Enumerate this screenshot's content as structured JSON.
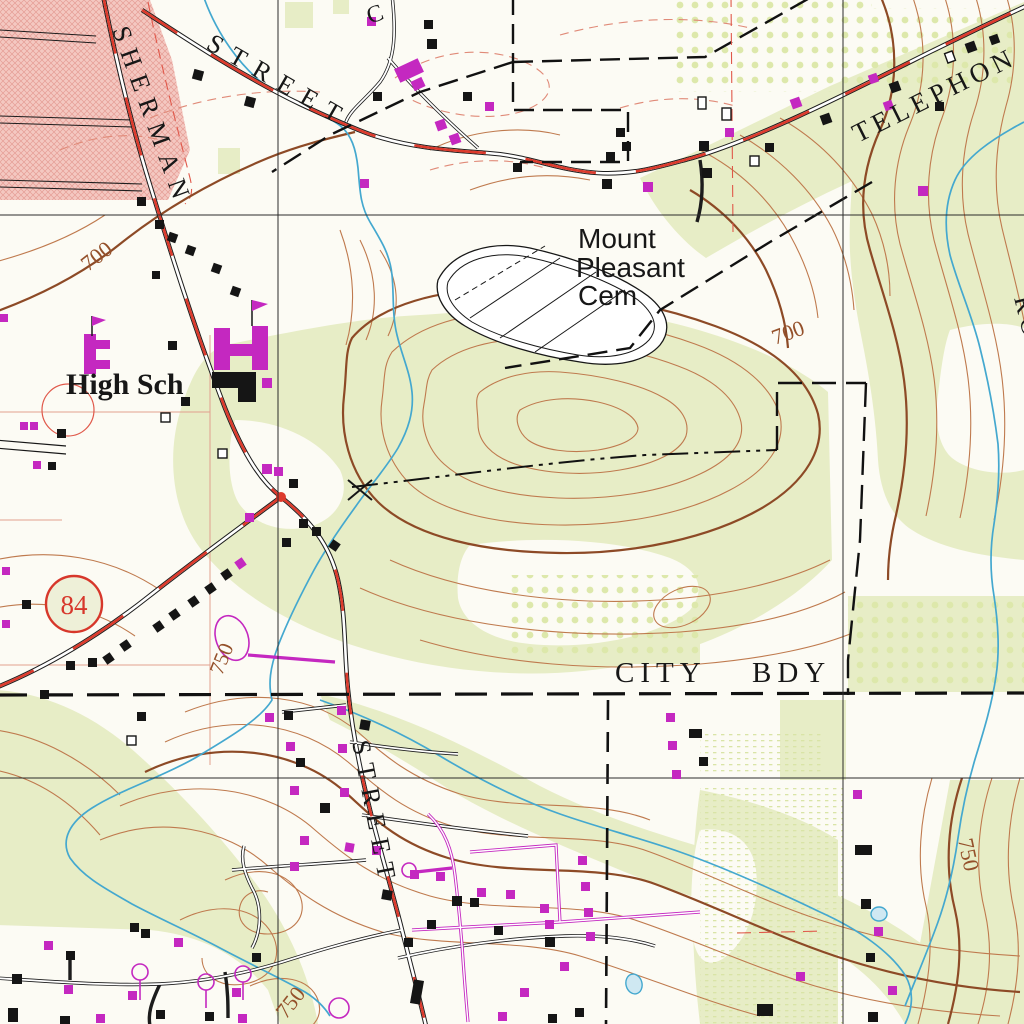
{
  "map": {
    "kind": "USGS topographic map excerpt",
    "labels": {
      "sherman": "SHERMAN",
      "street_top": "STREET",
      "street_bottom": "STREET",
      "telephone_partial": "TELEPHON",
      "c_partial": "C",
      "road_partial": "ROAD",
      "cemetery_line1": "Mount",
      "cemetery_line2": "Pleasant",
      "cemetery_line3": "Cem",
      "high_school": "High Sch",
      "city_bdy_word1": "CITY",
      "city_bdy_word2": "BDY",
      "route_number": "84"
    },
    "contour_labels": [
      {
        "text": "700"
      },
      {
        "text": "700"
      },
      {
        "text": "750"
      },
      {
        "text": "750"
      },
      {
        "text": "750"
      }
    ],
    "colors": {
      "paper": "#fcfbf4",
      "woodland_green": "#e7edc6",
      "orchard_dot": "#d5e39d",
      "urban_pink": "#f4c8c1",
      "urban_hatch": "#e59d95",
      "contour_brown": "#bf7a4e",
      "index_contour_brown": "#8d4a26",
      "road_red": "#dd3a2c",
      "photorev_magenta": "#c428c0",
      "water_blue": "#44a8cf",
      "pond_fill": "#cfe8f2",
      "ink_black": "#151515",
      "section_red": "#e0584a",
      "grid_black": "#2b2b2b"
    },
    "buildings": [
      [
        193,
        70,
        10,
        10,
        "b",
        15
      ],
      [
        245,
        97,
        10,
        10,
        "b",
        15
      ],
      [
        367,
        17,
        9,
        9,
        "m",
        0
      ],
      [
        424,
        20,
        9,
        9,
        "b",
        0
      ],
      [
        427,
        39,
        10,
        10,
        "b",
        0
      ],
      [
        137,
        197,
        9,
        9,
        "b",
        0
      ],
      [
        155,
        220,
        9,
        9,
        "b",
        0
      ],
      [
        168,
        233,
        9,
        9,
        "b",
        20
      ],
      [
        186,
        246,
        9,
        9,
        "b",
        20
      ],
      [
        152,
        271,
        8,
        8,
        "b",
        0
      ],
      [
        212,
        264,
        9,
        9,
        "b",
        20
      ],
      [
        231,
        287,
        9,
        9,
        "b",
        20
      ],
      [
        396,
        63,
        26,
        15,
        "m",
        -25
      ],
      [
        412,
        79,
        12,
        10,
        "m",
        -25
      ],
      [
        373,
        92,
        9,
        9,
        "b",
        0
      ],
      [
        463,
        92,
        9,
        9,
        "b",
        0
      ],
      [
        485,
        102,
        9,
        9,
        "m",
        0
      ],
      [
        436,
        120,
        10,
        10,
        "m",
        -20
      ],
      [
        450,
        134,
        10,
        10,
        "m",
        -20
      ],
      [
        360,
        179,
        9,
        9,
        "m",
        0
      ],
      [
        513,
        163,
        9,
        9,
        "b",
        0
      ],
      [
        602,
        179,
        10,
        10,
        "b",
        0
      ],
      [
        643,
        182,
        10,
        10,
        "m",
        0
      ],
      [
        616,
        128,
        9,
        9,
        "b",
        0
      ],
      [
        622,
        142,
        9,
        9,
        "b",
        0
      ],
      [
        606,
        152,
        9,
        9,
        "b",
        0
      ],
      [
        698,
        97,
        8,
        12,
        "h",
        0
      ],
      [
        722,
        108,
        9,
        12,
        "h",
        0
      ],
      [
        725,
        128,
        9,
        9,
        "m",
        0
      ],
      [
        699,
        141,
        10,
        10,
        "b",
        0
      ],
      [
        750,
        156,
        9,
        10,
        "h",
        0
      ],
      [
        702,
        168,
        10,
        10,
        "b",
        0
      ],
      [
        765,
        143,
        9,
        9,
        "b",
        0
      ],
      [
        791,
        98,
        10,
        10,
        "m",
        -20
      ],
      [
        821,
        114,
        10,
        10,
        "b",
        -20
      ],
      [
        869,
        74,
        9,
        9,
        "m",
        -20
      ],
      [
        890,
        82,
        10,
        10,
        "b",
        -20
      ],
      [
        884,
        101,
        9,
        9,
        "m",
        -20
      ],
      [
        946,
        52,
        8,
        10,
        "h",
        -20
      ],
      [
        966,
        42,
        10,
        10,
        "b",
        -20
      ],
      [
        990,
        35,
        9,
        9,
        "b",
        -20
      ],
      [
        935,
        102,
        9,
        9,
        "b",
        0
      ],
      [
        918,
        186,
        10,
        10,
        "m",
        0
      ],
      [
        84,
        334,
        12,
        40,
        "m",
        0
      ],
      [
        96,
        340,
        14,
        9,
        "m",
        0
      ],
      [
        96,
        360,
        14,
        9,
        "m",
        0
      ],
      [
        168,
        341,
        9,
        9,
        "b",
        0
      ],
      [
        214,
        328,
        16,
        42,
        "m",
        0
      ],
      [
        252,
        326,
        16,
        44,
        "m",
        0
      ],
      [
        230,
        344,
        22,
        12,
        "m",
        0
      ],
      [
        212,
        372,
        44,
        16,
        "b",
        0
      ],
      [
        238,
        388,
        18,
        14,
        "b",
        0
      ],
      [
        262,
        378,
        10,
        10,
        "m",
        0
      ],
      [
        181,
        397,
        9,
        9,
        "b",
        0
      ],
      [
        161,
        413,
        9,
        9,
        "h",
        0
      ],
      [
        20,
        422,
        8,
        8,
        "m",
        0
      ],
      [
        30,
        422,
        8,
        8,
        "m",
        0
      ],
      [
        57,
        429,
        9,
        9,
        "b",
        0
      ],
      [
        33,
        461,
        8,
        8,
        "m",
        0
      ],
      [
        48,
        462,
        8,
        8,
        "b",
        0
      ],
      [
        0,
        314,
        8,
        8,
        "m",
        0
      ],
      [
        218,
        449,
        9,
        9,
        "h",
        0
      ],
      [
        262,
        464,
        10,
        10,
        "m",
        0
      ],
      [
        274,
        467,
        9,
        9,
        "m",
        0
      ],
      [
        289,
        479,
        9,
        9,
        "b",
        0
      ],
      [
        299,
        519,
        9,
        9,
        "b",
        0
      ],
      [
        312,
        527,
        9,
        9,
        "b",
        0
      ],
      [
        245,
        513,
        9,
        9,
        "m",
        0
      ],
      [
        282,
        538,
        9,
        9,
        "b",
        0
      ],
      [
        330,
        541,
        9,
        9,
        "b",
        35
      ],
      [
        222,
        570,
        9,
        9,
        "b",
        -35
      ],
      [
        206,
        584,
        9,
        9,
        "b",
        -35
      ],
      [
        189,
        597,
        9,
        9,
        "b",
        -35
      ],
      [
        236,
        559,
        9,
        9,
        "m",
        -35
      ],
      [
        170,
        610,
        9,
        9,
        "b",
        -35
      ],
      [
        154,
        622,
        9,
        9,
        "b",
        -35
      ],
      [
        121,
        641,
        9,
        9,
        "b",
        -35
      ],
      [
        104,
        654,
        9,
        9,
        "b",
        -35
      ],
      [
        66,
        661,
        9,
        9,
        "b",
        0
      ],
      [
        88,
        658,
        9,
        9,
        "b",
        0
      ],
      [
        2,
        567,
        8,
        8,
        "m",
        0
      ],
      [
        22,
        600,
        9,
        9,
        "b",
        0
      ],
      [
        2,
        620,
        8,
        8,
        "m",
        0
      ],
      [
        40,
        690,
        9,
        9,
        "b",
        0
      ],
      [
        137,
        712,
        9,
        9,
        "b",
        0
      ],
      [
        127,
        736,
        9,
        9,
        "h",
        0
      ],
      [
        265,
        713,
        9,
        9,
        "m",
        0
      ],
      [
        284,
        711,
        9,
        9,
        "b",
        0
      ],
      [
        337,
        706,
        9,
        9,
        "m",
        0
      ],
      [
        360,
        720,
        10,
        10,
        "b",
        10
      ],
      [
        286,
        742,
        9,
        9,
        "m",
        0
      ],
      [
        338,
        744,
        9,
        9,
        "m",
        0
      ],
      [
        296,
        758,
        9,
        9,
        "b",
        0
      ],
      [
        290,
        786,
        9,
        9,
        "m",
        0
      ],
      [
        340,
        788,
        9,
        9,
        "m",
        0
      ],
      [
        320,
        803,
        10,
        10,
        "b",
        0
      ],
      [
        300,
        836,
        9,
        9,
        "m",
        0
      ],
      [
        345,
        843,
        9,
        9,
        "m",
        10
      ],
      [
        372,
        846,
        9,
        9,
        "m",
        0
      ],
      [
        290,
        862,
        9,
        9,
        "m",
        0
      ],
      [
        382,
        890,
        10,
        10,
        "b",
        10
      ],
      [
        410,
        870,
        9,
        9,
        "m",
        0
      ],
      [
        436,
        872,
        9,
        9,
        "m",
        0
      ],
      [
        452,
        896,
        10,
        10,
        "b",
        0
      ],
      [
        470,
        898,
        9,
        9,
        "b",
        0
      ],
      [
        477,
        888,
        9,
        9,
        "m",
        0
      ],
      [
        506,
        890,
        9,
        9,
        "m",
        0
      ],
      [
        540,
        904,
        9,
        9,
        "m",
        0
      ],
      [
        545,
        920,
        9,
        9,
        "m",
        0
      ],
      [
        494,
        926,
        9,
        9,
        "b",
        0
      ],
      [
        412,
        980,
        10,
        24,
        "b",
        10
      ],
      [
        545,
        937,
        10,
        10,
        "b",
        0
      ],
      [
        427,
        920,
        9,
        9,
        "b",
        0
      ],
      [
        404,
        938,
        9,
        9,
        "b",
        0
      ],
      [
        578,
        856,
        9,
        9,
        "m",
        0
      ],
      [
        581,
        882,
        9,
        9,
        "m",
        0
      ],
      [
        584,
        908,
        9,
        9,
        "m",
        0
      ],
      [
        586,
        932,
        9,
        9,
        "m",
        0
      ],
      [
        560,
        962,
        9,
        9,
        "m",
        0
      ],
      [
        520,
        988,
        9,
        9,
        "m",
        0
      ],
      [
        548,
        1014,
        9,
        9,
        "b",
        0
      ],
      [
        498,
        1012,
        9,
        9,
        "m",
        0
      ],
      [
        575,
        1008,
        9,
        9,
        "b",
        0
      ],
      [
        666,
        713,
        9,
        9,
        "m",
        0
      ],
      [
        689,
        729,
        13,
        9,
        "b",
        0
      ],
      [
        668,
        741,
        9,
        9,
        "m",
        0
      ],
      [
        672,
        770,
        9,
        9,
        "m",
        0
      ],
      [
        699,
        757,
        9,
        9,
        "b",
        0
      ],
      [
        853,
        790,
        9,
        9,
        "m",
        0
      ],
      [
        855,
        845,
        17,
        10,
        "b",
        0
      ],
      [
        861,
        899,
        10,
        10,
        "b",
        0
      ],
      [
        874,
        927,
        9,
        9,
        "m",
        0
      ],
      [
        866,
        953,
        9,
        9,
        "b",
        0
      ],
      [
        888,
        986,
        9,
        9,
        "m",
        0
      ],
      [
        868,
        1012,
        10,
        10,
        "b",
        0
      ],
      [
        44,
        941,
        9,
        9,
        "m",
        0
      ],
      [
        12,
        974,
        10,
        10,
        "b",
        0
      ],
      [
        66,
        951,
        9,
        9,
        "b",
        0
      ],
      [
        64,
        985,
        9,
        9,
        "m",
        0
      ],
      [
        130,
        923,
        9,
        9,
        "b",
        0
      ],
      [
        141,
        929,
        9,
        9,
        "b",
        0
      ],
      [
        128,
        991,
        9,
        9,
        "m",
        0
      ],
      [
        174,
        938,
        9,
        9,
        "m",
        0
      ],
      [
        252,
        953,
        9,
        9,
        "b",
        0
      ],
      [
        232,
        988,
        9,
        9,
        "m",
        0
      ],
      [
        205,
        1012,
        9,
        9,
        "b",
        0
      ],
      [
        238,
        1014,
        9,
        9,
        "m",
        0
      ],
      [
        96,
        1014,
        9,
        9,
        "m",
        0
      ],
      [
        156,
        1010,
        9,
        9,
        "b",
        0
      ],
      [
        8,
        1008,
        10,
        14,
        "b",
        0
      ],
      [
        60,
        1016,
        10,
        10,
        "b",
        0
      ],
      [
        757,
        1004,
        16,
        12,
        "b",
        0
      ],
      [
        796,
        972,
        9,
        9,
        "m",
        0
      ]
    ]
  }
}
